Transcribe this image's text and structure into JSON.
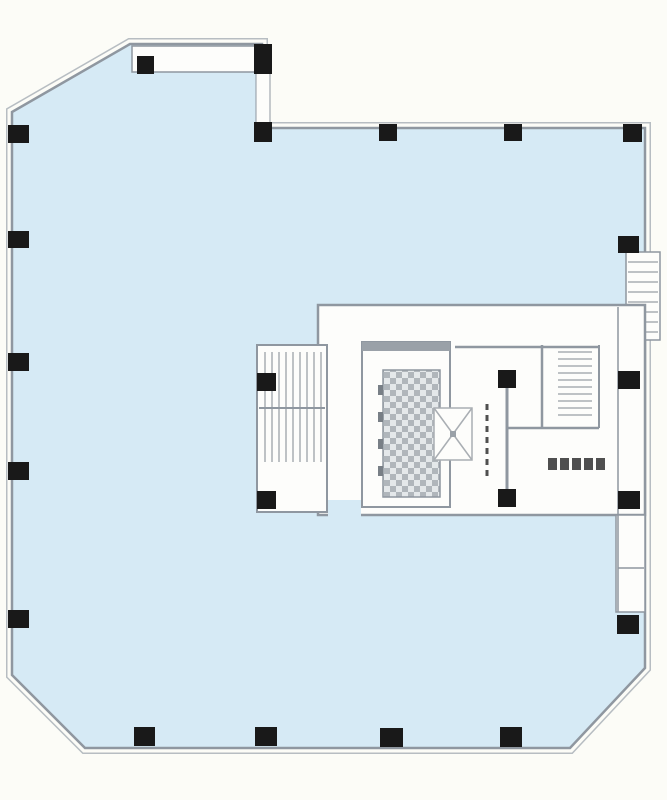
{
  "meta": {
    "title": "building-typical-floor-plan",
    "canvas_width": 667,
    "canvas_height": 800
  },
  "palette": {
    "background": "#fcfcf7",
    "floor_fill": "#d6eaf5",
    "wall_line": "#8f97a0",
    "wall_line_light": "#b7bdc2",
    "wall_gray": "#9aa1a8",
    "interior_fill": "#fdfdfb",
    "column_fill": "#191919",
    "stair_line": "#a9aeb3",
    "hatch_dark": "#b0b6bb",
    "hatch_light": "#e4e8ea",
    "mark_fill": "#4f4f4f",
    "jamb_fill": "#787f86"
  },
  "floor_outline": [
    [
      130,
      44
    ],
    [
      262,
      44
    ],
    [
      262,
      128
    ],
    [
      645,
      128
    ],
    [
      645,
      668
    ],
    [
      570,
      748
    ],
    [
      85,
      748
    ],
    [
      12,
      675
    ],
    [
      12,
      112
    ]
  ],
  "shapes": [
    {
      "t": "rect",
      "name": "rooftop-room",
      "x": 132,
      "y": 46,
      "w": 126,
      "h": 26,
      "fill": "interior_fill",
      "stroke": "wall_line",
      "sw": 1.5
    },
    {
      "t": "rect",
      "name": "step-wall",
      "x": 256,
      "y": 70,
      "w": 14,
      "h": 58,
      "fill": "interior_fill",
      "stroke": "wall_line",
      "sw": 1
    },
    {
      "t": "rect",
      "name": "external-stair",
      "x": 626,
      "y": 252,
      "w": 34,
      "h": 88,
      "fill": "interior_fill",
      "stroke": "wall_line",
      "sw": 1.5
    },
    {
      "t": "treads",
      "name": "external-stair-treads",
      "dir": "h",
      "x1": 628,
      "x2": 658,
      "from": 262,
      "to": 332,
      "step": 10
    },
    {
      "t": "rect",
      "name": "core-block",
      "x": 318,
      "y": 305,
      "w": 327,
      "h": 210,
      "fill": "interior_fill",
      "stroke": "wall_line",
      "sw": 2.5
    },
    {
      "t": "rect",
      "name": "service-band",
      "x": 616,
      "y": 515,
      "w": 29,
      "h": 97,
      "fill": "interior_fill",
      "stroke": "wall_line",
      "sw": 1.5
    },
    {
      "t": "rect",
      "name": "core-entrance-notch",
      "x": 328,
      "y": 500,
      "w": 33,
      "h": 17,
      "fill": "floor_fill"
    },
    {
      "t": "rect",
      "name": "stair-west",
      "x": 257,
      "y": 345,
      "w": 70,
      "h": 167,
      "fill": "interior_fill",
      "stroke": "wall_line",
      "sw": 2
    },
    {
      "t": "treads",
      "name": "stair-west-treads",
      "dir": "v",
      "y1": 352,
      "y2": 462,
      "from": 265,
      "to": 321,
      "step": 7
    },
    {
      "t": "line",
      "name": "stair-west-mid-wall",
      "x1": 259,
      "y1": 408,
      "x2": 325,
      "y2": 408,
      "sw": 2
    },
    {
      "t": "rect",
      "name": "elevator-bank",
      "x": 362,
      "y": 342,
      "w": 88,
      "h": 165,
      "fill": "interior_fill",
      "stroke": "wall_line",
      "sw": 2
    },
    {
      "t": "rect",
      "name": "elevator-bank-top-wall",
      "x": 362,
      "y": 342,
      "w": 88,
      "h": 9,
      "fill": "wall_gray"
    },
    {
      "t": "hatch",
      "name": "elevator-shaft-hatched",
      "x": 383,
      "y": 370,
      "w": 57,
      "h": 127,
      "stroke": "wall_line",
      "sw": 1.5
    },
    {
      "t": "jambs",
      "name": "elevator-door-jambs",
      "x": 378,
      "y": 385,
      "count": 4,
      "w": 5,
      "h": 10,
      "stepy": 27
    },
    {
      "t": "xbox",
      "name": "machine-shaft",
      "x": 434,
      "y": 408,
      "w": 38,
      "h": 52
    },
    {
      "t": "dashline",
      "name": "shutter-door",
      "x": 487,
      "y1": 404,
      "y2": 476
    },
    {
      "t": "line",
      "name": "core-mid-wall",
      "x1": 507,
      "y1": 379,
      "x2": 507,
      "y2": 500,
      "sw": 3
    },
    {
      "t": "line",
      "name": "core-top-inner-wall",
      "x1": 455,
      "y1": 347,
      "x2": 599,
      "y2": 347,
      "sw": 2.5
    },
    {
      "t": "line",
      "name": "stair-east-west-wall",
      "x1": 542,
      "y1": 345,
      "x2": 542,
      "y2": 428,
      "sw": 2.5
    },
    {
      "t": "line",
      "name": "stair-east-east-wall",
      "x1": 599,
      "y1": 345,
      "x2": 599,
      "y2": 428,
      "sw": 2
    },
    {
      "t": "line",
      "name": "stair-east-bottom-wall",
      "x1": 507,
      "y1": 428,
      "x2": 599,
      "y2": 428,
      "sw": 2.5
    },
    {
      "t": "treads",
      "name": "stair-east-treads",
      "dir": "h",
      "x1": 558,
      "x2": 592,
      "from": 352,
      "to": 420,
      "step": 7
    },
    {
      "t": "line",
      "name": "service-band-inner-wall",
      "x1": 618,
      "y1": 307,
      "x2": 618,
      "y2": 612,
      "sw": 1.5
    },
    {
      "t": "line",
      "name": "service-band-divider",
      "x1": 618,
      "y1": 568,
      "x2": 644,
      "y2": 568,
      "sw": 1.5
    },
    {
      "t": "marks",
      "name": "illegible-label-marks",
      "x": 548,
      "y": 458,
      "count": 5,
      "w": 9,
      "h": 12,
      "gap": 3
    }
  ],
  "columns": [
    {
      "name": "column-step-top",
      "x": 254,
      "y": 44,
      "w": 18,
      "h": 30
    },
    {
      "name": "column-step-corner",
      "x": 254,
      "y": 122,
      "w": 18,
      "h": 20
    },
    {
      "name": "column-rooftop-room",
      "x": 137,
      "y": 56,
      "w": 17,
      "h": 18
    },
    {
      "name": "column-top-1",
      "x": 379,
      "y": 124,
      "w": 18,
      "h": 17
    },
    {
      "name": "column-top-2",
      "x": 504,
      "y": 124,
      "w": 18,
      "h": 17
    },
    {
      "name": "column-top-right-corner",
      "x": 623,
      "y": 124,
      "w": 19,
      "h": 18
    },
    {
      "name": "column-left-1",
      "x": 8,
      "y": 125,
      "w": 21,
      "h": 18
    },
    {
      "name": "column-left-2",
      "x": 8,
      "y": 231,
      "w": 21,
      "h": 17
    },
    {
      "name": "column-left-3",
      "x": 8,
      "y": 353,
      "w": 21,
      "h": 18
    },
    {
      "name": "column-left-4",
      "x": 8,
      "y": 462,
      "w": 21,
      "h": 18
    },
    {
      "name": "column-left-5",
      "x": 8,
      "y": 610,
      "w": 21,
      "h": 18
    },
    {
      "name": "column-bottom-1",
      "x": 134,
      "y": 727,
      "w": 21,
      "h": 19
    },
    {
      "name": "column-bottom-2",
      "x": 255,
      "y": 727,
      "w": 22,
      "h": 19
    },
    {
      "name": "column-bottom-3",
      "x": 380,
      "y": 728,
      "w": 23,
      "h": 19
    },
    {
      "name": "column-bottom-4",
      "x": 500,
      "y": 727,
      "w": 22,
      "h": 20
    },
    {
      "name": "column-right-1",
      "x": 618,
      "y": 236,
      "w": 21,
      "h": 17
    },
    {
      "name": "column-right-2",
      "x": 618,
      "y": 371,
      "w": 22,
      "h": 18
    },
    {
      "name": "column-right-3",
      "x": 618,
      "y": 491,
      "w": 22,
      "h": 18
    },
    {
      "name": "column-right-4",
      "x": 617,
      "y": 615,
      "w": 22,
      "h": 19
    },
    {
      "name": "column-core-west-1",
      "x": 257,
      "y": 373,
      "w": 19,
      "h": 18
    },
    {
      "name": "column-core-west-2",
      "x": 257,
      "y": 491,
      "w": 19,
      "h": 18
    },
    {
      "name": "column-core-mid-1",
      "x": 498,
      "y": 370,
      "w": 18,
      "h": 18
    },
    {
      "name": "column-core-mid-2",
      "x": 498,
      "y": 489,
      "w": 18,
      "h": 18
    }
  ]
}
